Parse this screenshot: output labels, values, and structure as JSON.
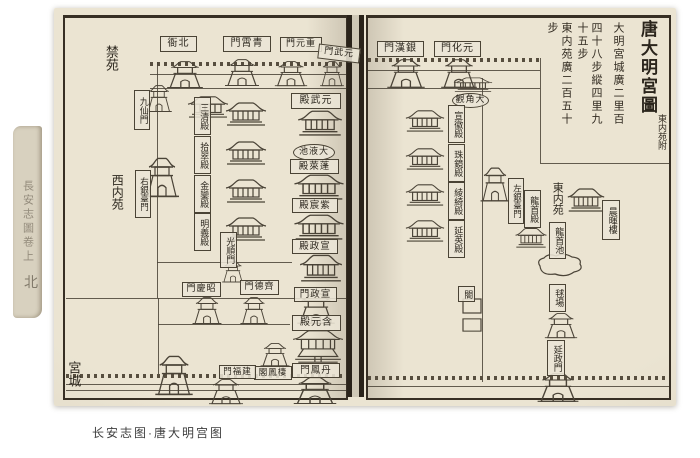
{
  "caption": "长安志图·唐大明宫图",
  "spine_text": "長安志圖卷上",
  "spine_char": "北",
  "ink_color": "#4a4337",
  "paper_color": "#e7e0cd",
  "title_block": {
    "title": "唐大明宮圖",
    "subtitle": "東内苑附",
    "notes": [
      "大明宮城廣二里百",
      "四十八步縱四里九",
      "十五步",
      "東内苑廣二百五十",
      "步"
    ]
  },
  "labels": [
    {
      "n": "jinyuan-region",
      "t": "禁苑",
      "x": 101,
      "y": 36,
      "w": 18,
      "h": 44,
      "d": "v",
      "f": "none",
      "fs": 13
    },
    {
      "n": "xineiyuan-region",
      "t": "西内苑",
      "x": 108,
      "y": 166,
      "w": 18,
      "h": 52,
      "d": "v",
      "f": "none",
      "fs": 12
    },
    {
      "n": "gongcheng-region",
      "t": "宮城",
      "x": 64,
      "y": 356,
      "w": 17,
      "h": 36,
      "d": "v",
      "f": "none",
      "fs": 13
    },
    {
      "n": "beiya-label",
      "t": "北衙",
      "x": 160,
      "y": 36,
      "w": 35,
      "h": 14,
      "d": "h",
      "f": "box",
      "fs": 10,
      "r": 1
    },
    {
      "n": "qingxiao-gate-label",
      "t": "青霄門",
      "x": 223,
      "y": 36,
      "w": 46,
      "h": 14,
      "d": "h",
      "f": "box",
      "fs": 10,
      "r": 1
    },
    {
      "n": "chongyuan-gate-label",
      "t": "重元門",
      "x": 280,
      "y": 37,
      "w": 40,
      "h": 13,
      "d": "h",
      "f": "box",
      "fs": 9,
      "r": 1
    },
    {
      "n": "yuanwu-gate-label",
      "t": "元武門",
      "x": 318,
      "y": 46,
      "w": 40,
      "h": 13,
      "d": "h",
      "f": "box",
      "fs": 9,
      "r": 1,
      "rot": 7
    },
    {
      "n": "jiuxian-gate-label",
      "t": "九仙門",
      "x": 134,
      "y": 90,
      "w": 14,
      "h": 38,
      "d": "v",
      "f": "box",
      "fs": 9
    },
    {
      "n": "youyintai-gate-label",
      "t": "右銀臺門",
      "x": 135,
      "y": 170,
      "w": 14,
      "h": 46,
      "d": "v",
      "f": "box",
      "fs": 8.5
    },
    {
      "n": "sanqing-hall-label",
      "t": "三清殿",
      "x": 194,
      "y": 97,
      "w": 15,
      "h": 36,
      "d": "v",
      "f": "box",
      "fs": 9
    },
    {
      "n": "shicui-hall-label",
      "t": "拾翠殿",
      "x": 194,
      "y": 136,
      "w": 15,
      "h": 36,
      "d": "v",
      "f": "box",
      "fs": 9
    },
    {
      "n": "jinluan-hall-label",
      "t": "金鑾殿",
      "x": 194,
      "y": 175,
      "w": 15,
      "h": 36,
      "d": "v",
      "f": "box",
      "fs": 9
    },
    {
      "n": "mingyi-hall-label",
      "t": "明義殿",
      "x": 194,
      "y": 213,
      "w": 15,
      "h": 36,
      "d": "v",
      "f": "box",
      "fs": 9
    },
    {
      "n": "guangshun-gate-label",
      "t": "光順門",
      "x": 220,
      "y": 232,
      "w": 15,
      "h": 34,
      "d": "v",
      "f": "box",
      "fs": 9
    },
    {
      "n": "yuanwu-hall-label",
      "t": "元武殿",
      "x": 291,
      "y": 93,
      "w": 48,
      "h": 14,
      "d": "h",
      "f": "box",
      "fs": 10,
      "r": 1
    },
    {
      "n": "taiye-pool-label",
      "t": "大液池",
      "x": 293,
      "y": 144,
      "w": 40,
      "h": 15,
      "d": "h",
      "f": "oval",
      "fs": 9,
      "r": 1
    },
    {
      "n": "penglai-hall-label",
      "t": "蓬萊殿",
      "x": 290,
      "y": 159,
      "w": 47,
      "h": 13,
      "d": "h",
      "f": "box",
      "fs": 9.5,
      "r": 1
    },
    {
      "n": "zichen-hall-label",
      "t": "紫宸殿",
      "x": 292,
      "y": 198,
      "w": 44,
      "h": 13,
      "d": "h",
      "f": "box",
      "fs": 9.5,
      "r": 1
    },
    {
      "n": "xuanzheng-hall-label",
      "t": "宣政殿",
      "x": 292,
      "y": 239,
      "w": 44,
      "h": 13,
      "d": "h",
      "f": "box",
      "fs": 9.5,
      "r": 1
    },
    {
      "n": "zhaoqing-gate-label",
      "t": "昭慶門",
      "x": 182,
      "y": 282,
      "w": 37,
      "h": 13,
      "d": "h",
      "f": "box",
      "fs": 9,
      "r": 1
    },
    {
      "n": "qide-gate-label",
      "t": "齊德門",
      "x": 240,
      "y": 280,
      "w": 37,
      "h": 13,
      "d": "h",
      "f": "box",
      "fs": 9,
      "r": 1
    },
    {
      "n": "xuanzheng-gate-label",
      "t": "宣政門",
      "x": 294,
      "y": 287,
      "w": 41,
      "h": 13,
      "d": "h",
      "f": "box",
      "fs": 9.5,
      "r": 1
    },
    {
      "n": "hanyuan-hall-label",
      "t": "含元殿",
      "x": 292,
      "y": 315,
      "w": 47,
      "h": 14,
      "d": "h",
      "f": "box",
      "fs": 10,
      "r": 1
    },
    {
      "n": "qifeng-pavilion-label",
      "t": "棲鳳閣",
      "x": 254,
      "y": 366,
      "w": 36,
      "h": 12,
      "d": "h",
      "f": "box",
      "fs": 8.5,
      "r": 1
    },
    {
      "n": "jianfu-gate-label",
      "t": "建福門",
      "x": 219,
      "y": 365,
      "w": 35,
      "h": 12,
      "d": "h",
      "f": "box",
      "fs": 8.5,
      "r": 1
    },
    {
      "n": "danfeng-gate-label",
      "t": "丹鳳門",
      "x": 292,
      "y": 363,
      "w": 46,
      "h": 13,
      "d": "h",
      "f": "box",
      "fs": 9.5,
      "r": 1
    },
    {
      "n": "yinhan-gate-label",
      "t": "銀漢門",
      "x": 377,
      "y": 41,
      "w": 45,
      "h": 14,
      "d": "h",
      "f": "box",
      "fs": 10,
      "r": 1
    },
    {
      "n": "yuanhua-gate-label",
      "t": "元化門",
      "x": 434,
      "y": 41,
      "w": 45,
      "h": 14,
      "d": "h",
      "f": "box",
      "fs": 10,
      "r": 1
    },
    {
      "n": "dajiao-temple-label",
      "t": "大角觀",
      "x": 452,
      "y": 93,
      "w": 35,
      "h": 13,
      "d": "h",
      "f": "oval",
      "fs": 9,
      "r": 1
    },
    {
      "n": "xuanhui-hall-label",
      "t": "宣徽殿",
      "x": 448,
      "y": 105,
      "w": 15,
      "h": 36,
      "d": "v",
      "f": "box",
      "fs": 9
    },
    {
      "n": "zhujing-hall-label",
      "t": "珠鏡殿",
      "x": 448,
      "y": 144,
      "w": 15,
      "h": 36,
      "d": "v",
      "f": "box",
      "fs": 9
    },
    {
      "n": "lingqi-hall-label",
      "t": "綾綺殿",
      "x": 448,
      "y": 182,
      "w": 15,
      "h": 36,
      "d": "v",
      "f": "box",
      "fs": 9
    },
    {
      "n": "yanying-hall-label",
      "t": "延英殿",
      "x": 448,
      "y": 220,
      "w": 15,
      "h": 36,
      "d": "v",
      "f": "box",
      "fs": 9
    },
    {
      "n": "zuoyintai-gate-label",
      "t": "左銀臺門",
      "x": 508,
      "y": 178,
      "w": 14,
      "h": 44,
      "d": "v",
      "f": "box",
      "fs": 8.5
    },
    {
      "n": "longshou-hall-label",
      "t": "龍首殿",
      "x": 524,
      "y": 190,
      "w": 15,
      "h": 36,
      "d": "v",
      "f": "box",
      "fs": 9
    },
    {
      "n": "dongneiyuan-region",
      "t": "東内苑",
      "x": 549,
      "y": 178,
      "w": 17,
      "h": 40,
      "d": "v",
      "f": "none",
      "fs": 11
    },
    {
      "n": "longshou-pool-label",
      "t": "龍首池",
      "x": 549,
      "y": 222,
      "w": 15,
      "h": 35,
      "d": "v",
      "f": "box",
      "fs": 9
    },
    {
      "n": "chenhui-tower-label",
      "t": "晨暉樓",
      "x": 602,
      "y": 200,
      "w": 16,
      "h": 38,
      "d": "v",
      "f": "box",
      "fs": 9
    },
    {
      "n": "qiuchang-label",
      "t": "毬場",
      "x": 549,
      "y": 284,
      "w": 15,
      "h": 26,
      "d": "v",
      "f": "box",
      "fs": 9
    },
    {
      "n": "yanzheng-gate-label",
      "t": "延政門",
      "x": 547,
      "y": 340,
      "w": 16,
      "h": 34,
      "d": "v",
      "f": "box",
      "fs": 9
    },
    {
      "n": "ge-gate-label",
      "t": "閤",
      "x": 458,
      "y": 286,
      "w": 15,
      "h": 14,
      "d": "v",
      "f": "box",
      "fs": 9
    }
  ],
  "buildings": [
    {
      "t": "gate",
      "n": "north-wall-tower",
      "x": 164,
      "y": 60,
      "w": 42,
      "h": 30
    },
    {
      "t": "gate",
      "n": "qingxiao-gate-tower",
      "x": 222,
      "y": 58,
      "w": 40,
      "h": 30
    },
    {
      "t": "gate",
      "n": "north-wall-tower",
      "x": 272,
      "y": 60,
      "w": 38,
      "h": 28
    },
    {
      "t": "gate",
      "n": "yuanwu-gate-tower",
      "x": 318,
      "y": 60,
      "w": 28,
      "h": 28
    },
    {
      "t": "hall",
      "n": "inner-hall",
      "x": 186,
      "y": 94,
      "w": 44,
      "h": 24
    },
    {
      "t": "gate",
      "n": "jiuxian-gate-tower",
      "x": 144,
      "y": 84,
      "w": 30,
      "h": 30
    },
    {
      "t": "gate",
      "n": "youyintai-gate-tower",
      "x": 142,
      "y": 156,
      "w": 40,
      "h": 44
    },
    {
      "t": "hall",
      "n": "sanqing-hall-building",
      "x": 224,
      "y": 100,
      "w": 44,
      "h": 26
    },
    {
      "t": "hall",
      "n": "shicui-hall-building",
      "x": 224,
      "y": 139,
      "w": 44,
      "h": 26
    },
    {
      "t": "hall",
      "n": "jinluan-hall-building",
      "x": 224,
      "y": 177,
      "w": 44,
      "h": 26
    },
    {
      "t": "hall",
      "n": "mingyi-hall-building",
      "x": 224,
      "y": 215,
      "w": 44,
      "h": 26
    },
    {
      "t": "gate",
      "n": "guangshun-gate-tower",
      "x": 220,
      "y": 260,
      "w": 26,
      "h": 24
    },
    {
      "t": "hall",
      "n": "yuanwu-hall-building",
      "x": 296,
      "y": 108,
      "w": 48,
      "h": 28
    },
    {
      "t": "hall",
      "n": "penglai-hall-building",
      "x": 292,
      "y": 172,
      "w": 54,
      "h": 28
    },
    {
      "t": "hall",
      "n": "zichen-hall-building",
      "x": 292,
      "y": 212,
      "w": 54,
      "h": 28
    },
    {
      "t": "hall",
      "n": "xuanzheng-hall-building",
      "x": 298,
      "y": 252,
      "w": 46,
      "h": 30
    },
    {
      "t": "gate",
      "n": "zhaoqing-gate-tower",
      "x": 190,
      "y": 296,
      "w": 34,
      "h": 30
    },
    {
      "t": "gate",
      "n": "qide-gate-tower",
      "x": 238,
      "y": 296,
      "w": 32,
      "h": 30
    },
    {
      "t": "gate",
      "n": "xuanzheng-gate-tower",
      "x": 294,
      "y": 292,
      "w": 44,
      "h": 34
    },
    {
      "t": "hall2",
      "n": "hanyuan-hall-building",
      "x": 290,
      "y": 328,
      "w": 56,
      "h": 38
    },
    {
      "t": "gate",
      "n": "qifeng-pavilion-tower",
      "x": 258,
      "y": 342,
      "w": 34,
      "h": 26
    },
    {
      "t": "gate",
      "n": "jianfu-gate-tower",
      "x": 206,
      "y": 378,
      "w": 40,
      "h": 28
    },
    {
      "t": "gate",
      "n": "danfeng-gate-tower",
      "x": 290,
      "y": 376,
      "w": 50,
      "h": 30
    },
    {
      "t": "gate",
      "n": "southwest-corner-tower",
      "x": 152,
      "y": 354,
      "w": 44,
      "h": 44
    },
    {
      "t": "gate",
      "n": "yinhan-gate-tower",
      "x": 384,
      "y": 58,
      "w": 44,
      "h": 32
    },
    {
      "t": "gate",
      "n": "yuanhua-gate-tower",
      "x": 438,
      "y": 58,
      "w": 42,
      "h": 32
    },
    {
      "t": "hall",
      "n": "north-inner-hall",
      "x": 452,
      "y": 76,
      "w": 42,
      "h": 16
    },
    {
      "t": "hall",
      "n": "xuanhui-hall-building",
      "x": 404,
      "y": 108,
      "w": 42,
      "h": 24
    },
    {
      "t": "hall",
      "n": "zhujing-hall-building",
      "x": 404,
      "y": 146,
      "w": 42,
      "h": 24
    },
    {
      "t": "hall",
      "n": "lingqi-hall-building",
      "x": 404,
      "y": 182,
      "w": 42,
      "h": 24
    },
    {
      "t": "hall",
      "n": "yanying-hall-building",
      "x": 404,
      "y": 218,
      "w": 42,
      "h": 24
    },
    {
      "t": "gate",
      "n": "zuoyintai-gate-tower",
      "x": 478,
      "y": 166,
      "w": 34,
      "h": 38
    },
    {
      "t": "hall",
      "n": "longshou-hall-building",
      "x": 514,
      "y": 226,
      "w": 34,
      "h": 22
    },
    {
      "t": "hall",
      "n": "chenhui-tower-building",
      "x": 566,
      "y": 186,
      "w": 40,
      "h": 26
    },
    {
      "t": "pond",
      "n": "longshou-pool-shape",
      "x": 534,
      "y": 252,
      "w": 52,
      "h": 28
    },
    {
      "t": "gate",
      "n": "qiuchang-tower",
      "x": 542,
      "y": 312,
      "w": 38,
      "h": 28
    },
    {
      "t": "gate",
      "n": "yanzheng-gate-tower",
      "x": 534,
      "y": 372,
      "w": 48,
      "h": 32
    },
    {
      "t": "box",
      "n": "small-court",
      "x": 462,
      "y": 298,
      "w": 20,
      "h": 16
    },
    {
      "t": "box",
      "n": "small-court",
      "x": 462,
      "y": 318,
      "w": 20,
      "h": 14
    }
  ],
  "walls": [
    {
      "k": "cren",
      "x": 150,
      "y": 62,
      "len": 196
    },
    {
      "k": "h",
      "x": 150,
      "y": 74,
      "len": 196
    },
    {
      "k": "h",
      "x": 150,
      "y": 88,
      "len": 196
    },
    {
      "k": "v",
      "x": 157,
      "y": 62,
      "len": 236
    },
    {
      "k": "h",
      "x": 157,
      "y": 262,
      "len": 135
    },
    {
      "k": "h",
      "x": 66,
      "y": 298,
      "len": 280
    },
    {
      "k": "v",
      "x": 158,
      "y": 298,
      "len": 76
    },
    {
      "k": "h",
      "x": 158,
      "y": 324,
      "len": 132
    },
    {
      "k": "cren",
      "x": 66,
      "y": 374,
      "len": 280
    },
    {
      "k": "h",
      "x": 66,
      "y": 384,
      "len": 280
    },
    {
      "k": "h",
      "x": 66,
      "y": 390,
      "len": 280
    },
    {
      "k": "cren",
      "x": 368,
      "y": 58,
      "len": 172
    },
    {
      "k": "h",
      "x": 368,
      "y": 70,
      "len": 172
    },
    {
      "k": "h",
      "x": 368,
      "y": 88,
      "len": 172
    },
    {
      "k": "v",
      "x": 540,
      "y": 58,
      "len": 105
    },
    {
      "k": "h",
      "x": 540,
      "y": 163,
      "len": 129
    },
    {
      "k": "v",
      "x": 482,
      "y": 78,
      "len": 304
    },
    {
      "k": "cren",
      "x": 368,
      "y": 376,
      "len": 301
    },
    {
      "k": "h",
      "x": 368,
      "y": 386,
      "len": 301
    }
  ]
}
